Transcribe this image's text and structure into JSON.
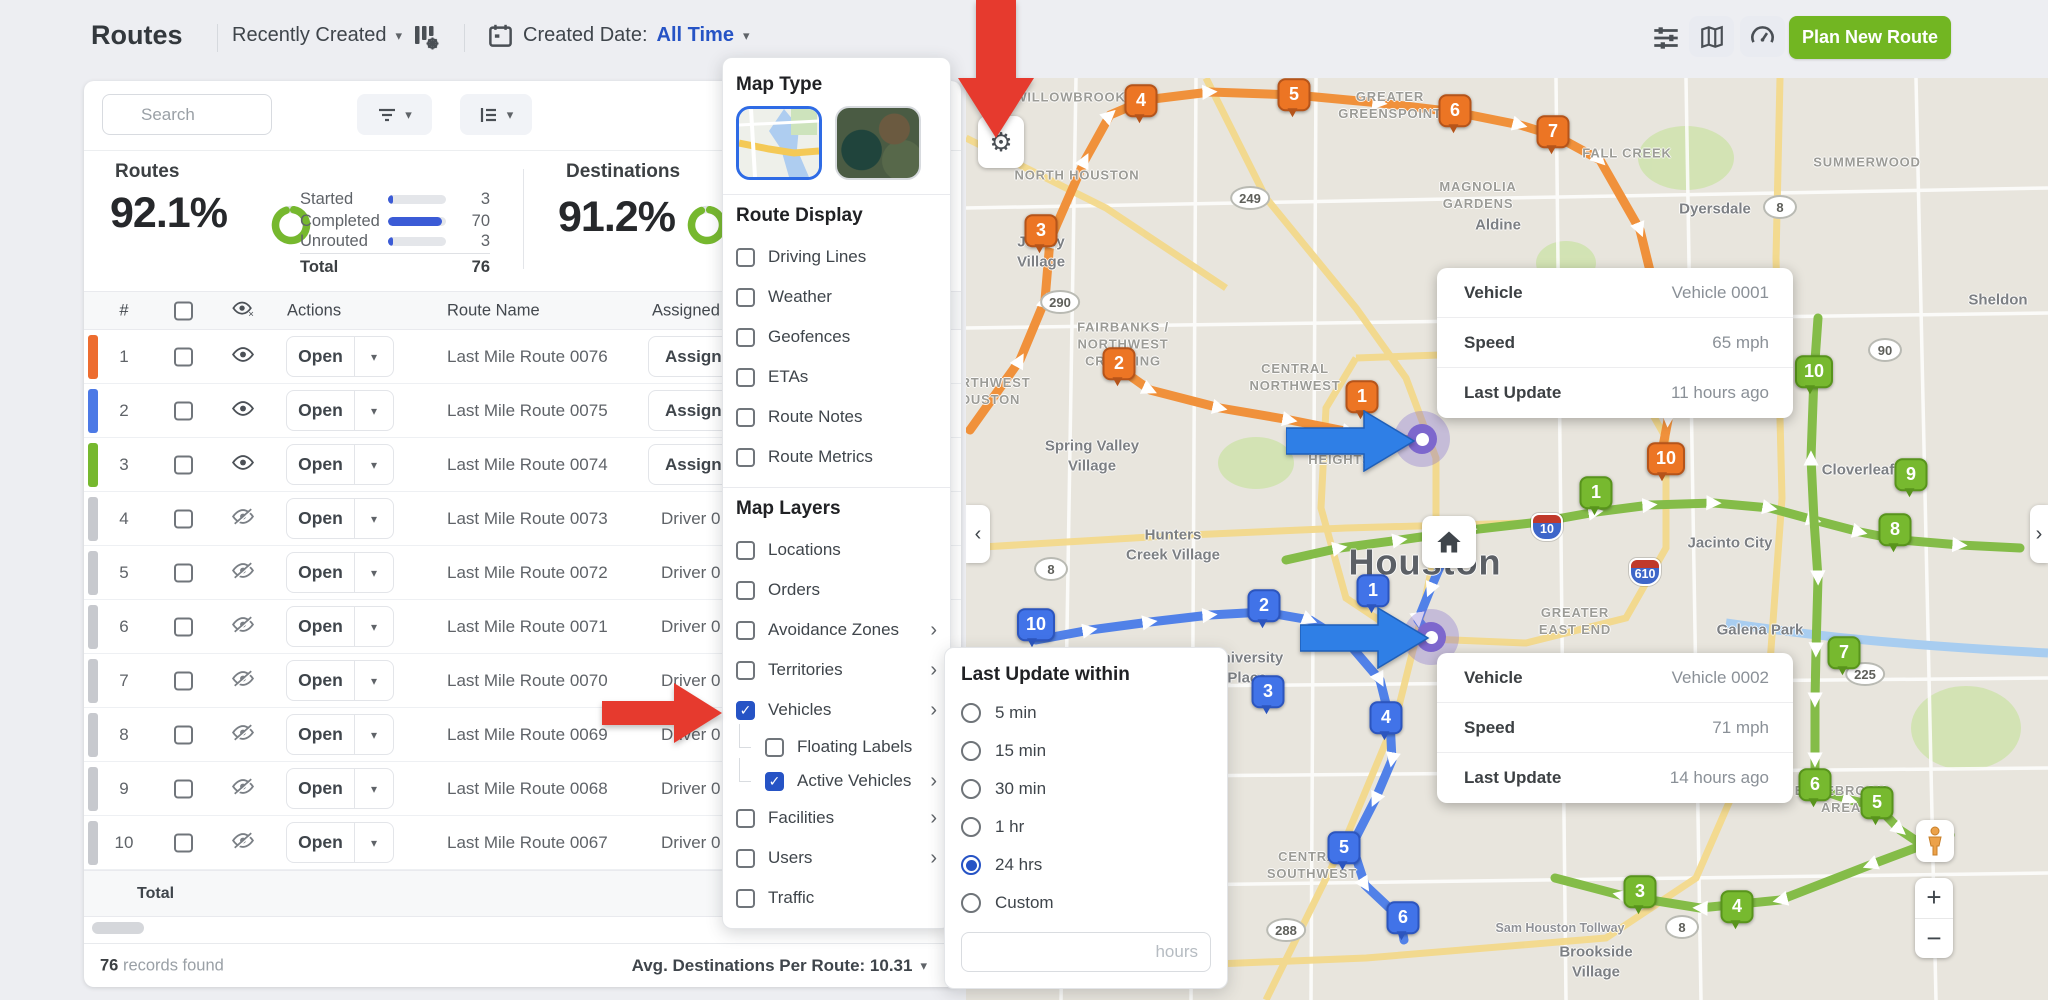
{
  "app": {
    "title": "Routes",
    "sort": "Recently Created",
    "created_date_label": "Created Date:",
    "created_date_value": "All Time",
    "plan_new_route": "Plan New Route",
    "search_placeholder": "Search"
  },
  "icons": {
    "caret_down": "▾",
    "check": "✓",
    "gear": "⚙",
    "collapse_left": "‹",
    "collapse_right": "›",
    "submenu_chevron": "›",
    "zoom_in": "+",
    "zoom_out": "−"
  },
  "stats": {
    "routes_label": "Routes",
    "routes_percent": "92.1%",
    "breakdown": [
      {
        "label": "Started",
        "value": "3",
        "pct": 8
      },
      {
        "label": "Completed",
        "value": "70",
        "pct": 93
      },
      {
        "label": "Unrouted",
        "value": "3",
        "pct": 8
      }
    ],
    "total_label": "Total",
    "total_value": "76",
    "destinations_label": "Destinations",
    "destinations_percent": "91.2%"
  },
  "table": {
    "headers": {
      "index": "#",
      "actions": "Actions",
      "route_name": "Route Name",
      "assigned": "Assigned"
    },
    "open_label": "Open",
    "total_label": "Total",
    "row_bar_colors": {
      "orange": "#ED6C2F",
      "blue": "#4C79E6",
      "green": "#76B82E",
      "gray": "#C7C9CE"
    },
    "rows": [
      {
        "n": "1",
        "bar": "orange",
        "eye": "on",
        "name": "Last Mile Route 0076",
        "assigned": "Assign U",
        "assigned_type": "button"
      },
      {
        "n": "2",
        "bar": "blue",
        "eye": "on",
        "name": "Last Mile Route 0075",
        "assigned": "Assign U",
        "assigned_type": "button"
      },
      {
        "n": "3",
        "bar": "green",
        "eye": "on",
        "name": "Last Mile Route 0074",
        "assigned": "Assign U",
        "assigned_type": "button"
      },
      {
        "n": "4",
        "bar": "gray",
        "eye": "off",
        "name": "Last Mile Route 0073",
        "assigned": "Driver 0",
        "assigned_type": "text"
      },
      {
        "n": "5",
        "bar": "gray",
        "eye": "off",
        "name": "Last Mile Route 0072",
        "assigned": "Driver 0",
        "assigned_type": "text"
      },
      {
        "n": "6",
        "bar": "gray",
        "eye": "off",
        "name": "Last Mile Route 0071",
        "assigned": "Driver 0",
        "assigned_type": "text"
      },
      {
        "n": "7",
        "bar": "gray",
        "eye": "off",
        "name": "Last Mile Route 0070",
        "assigned": "Driver 0",
        "assigned_type": "text"
      },
      {
        "n": "8",
        "bar": "gray",
        "eye": "off",
        "name": "Last Mile Route 0069",
        "assigned": "Driver 0",
        "assigned_type": "text"
      },
      {
        "n": "9",
        "bar": "gray",
        "eye": "off",
        "name": "Last Mile Route 0068",
        "assigned": "Driver 0",
        "assigned_type": "text"
      },
      {
        "n": "10",
        "bar": "gray",
        "eye": "off",
        "name": "Last Mile Route 0067",
        "assigned": "Driver 0",
        "assigned_type": "text"
      }
    ]
  },
  "footer": {
    "records_count": "76",
    "records_text": " records found",
    "avg_text": "Avg. Destinations Per Route: 10.31"
  },
  "map_settings": {
    "map_type_label": "Map Type",
    "route_display_label": "Route Display",
    "route_display": [
      {
        "label": "Driving Lines",
        "checked": false
      },
      {
        "label": "Weather",
        "checked": false
      },
      {
        "label": "Geofences",
        "checked": false
      },
      {
        "label": "ETAs",
        "checked": false
      },
      {
        "label": "Route Notes",
        "checked": false
      },
      {
        "label": "Route Metrics",
        "checked": false
      }
    ],
    "map_layers_label": "Map Layers",
    "map_layers": [
      {
        "label": "Locations",
        "checked": false
      },
      {
        "label": "Orders",
        "checked": false
      },
      {
        "label": "Avoidance Zones",
        "checked": false,
        "chevron": true
      },
      {
        "label": "Territories",
        "checked": false,
        "chevron": true
      },
      {
        "label": "Vehicles",
        "checked": true,
        "chevron": true
      },
      {
        "label": "Floating Labels",
        "checked": false,
        "indent": true
      },
      {
        "label": "Active Vehicles",
        "checked": true,
        "chevron": true,
        "indent": true
      },
      {
        "label": "Facilities",
        "checked": false,
        "chevron": true
      },
      {
        "label": "Users",
        "checked": false,
        "chevron": true
      },
      {
        "label": "Traffic",
        "checked": false
      }
    ]
  },
  "last_update": {
    "title": "Last Update within",
    "options": [
      "5 min",
      "15 min",
      "30 min",
      "1 hr",
      "24 hrs",
      "Custom"
    ],
    "selected": "24 hrs",
    "input_placeholder": "hours"
  },
  "vehicle_cards": [
    {
      "x": 1437,
      "y": 268,
      "rows": [
        [
          "Vehicle",
          "Vehicle 0001"
        ],
        [
          "Speed",
          "65 mph"
        ],
        [
          "Last Update",
          "11 hours ago"
        ]
      ]
    },
    {
      "x": 1437,
      "y": 653,
      "rows": [
        [
          "Vehicle",
          "Vehicle 0002"
        ],
        [
          "Speed",
          "71 mph"
        ],
        [
          "Last Update",
          "14 hours ago"
        ]
      ]
    }
  ],
  "map": {
    "markers": [
      {
        "c": "orange",
        "n": "4",
        "x": 1141,
        "y": 104
      },
      {
        "c": "orange",
        "n": "5",
        "x": 1294,
        "y": 98
      },
      {
        "c": "orange",
        "n": "6",
        "x": 1455,
        "y": 114
      },
      {
        "c": "orange",
        "n": "7",
        "x": 1553,
        "y": 135
      },
      {
        "c": "orange",
        "n": "3",
        "x": 1041,
        "y": 234
      },
      {
        "c": "orange",
        "n": "2",
        "x": 1119,
        "y": 367
      },
      {
        "c": "orange",
        "n": "1",
        "x": 1362,
        "y": 400
      },
      {
        "c": "orange",
        "n": "10",
        "x": 1666,
        "y": 462
      },
      {
        "c": "green",
        "n": "10",
        "x": 1814,
        "y": 375
      },
      {
        "c": "green",
        "n": "9",
        "x": 1911,
        "y": 478
      },
      {
        "c": "green",
        "n": "8",
        "x": 1895,
        "y": 533
      },
      {
        "c": "green",
        "n": "1",
        "x": 1596,
        "y": 496
      },
      {
        "c": "green",
        "n": "7",
        "x": 1844,
        "y": 656
      },
      {
        "c": "green",
        "n": "6",
        "x": 1815,
        "y": 788
      },
      {
        "c": "green",
        "n": "5",
        "x": 1877,
        "y": 806
      },
      {
        "c": "green",
        "n": "3",
        "x": 1640,
        "y": 895
      },
      {
        "c": "green",
        "n": "4",
        "x": 1737,
        "y": 910
      },
      {
        "c": "blue",
        "n": "10",
        "x": 1036,
        "y": 628
      },
      {
        "c": "blue",
        "n": "2",
        "x": 1264,
        "y": 609
      },
      {
        "c": "blue",
        "n": "1",
        "x": 1373,
        "y": 594
      },
      {
        "c": "blue",
        "n": "3",
        "x": 1268,
        "y": 695
      },
      {
        "c": "blue",
        "n": "4",
        "x": 1386,
        "y": 721
      },
      {
        "c": "blue",
        "n": "5",
        "x": 1344,
        "y": 851
      },
      {
        "c": "blue",
        "n": "6",
        "x": 1403,
        "y": 921
      }
    ],
    "labels": [
      {
        "text": "WILLOWBROOK",
        "x": 1070,
        "y": 98,
        "kind": "area"
      },
      {
        "text": "GREATER\nGREENSPOINT",
        "x": 1390,
        "y": 106,
        "kind": "area"
      },
      {
        "text": "NORTH HOUSTON",
        "x": 1077,
        "y": 176,
        "kind": "area"
      },
      {
        "text": "MAGNOLIA\nGARDENS",
        "x": 1478,
        "y": 196,
        "kind": "area"
      },
      {
        "text": "FALL CREEK",
        "x": 1627,
        "y": 154,
        "kind": "area"
      },
      {
        "text": "SUMMERWOOD",
        "x": 1867,
        "y": 163,
        "kind": "area"
      },
      {
        "text": "Dyersdale",
        "x": 1715,
        "y": 209,
        "kind": "city"
      },
      {
        "text": "Aldine",
        "x": 1498,
        "y": 225,
        "kind": "city"
      },
      {
        "text": "Jersey\nVillage",
        "x": 1041,
        "y": 252,
        "kind": "city"
      },
      {
        "text": "FAIRBANKS /\nNORTHWEST\nCROSSING",
        "x": 1123,
        "y": 345,
        "kind": "area"
      },
      {
        "text": "CENTRAL\nNORTHWEST",
        "x": 1295,
        "y": 378,
        "kind": "area"
      },
      {
        "text": "NORTHWEST\nHOUSTON",
        "x": 985,
        "y": 392,
        "kind": "area"
      },
      {
        "text": "GREATER\nHEIGHTS",
        "x": 1340,
        "y": 452,
        "kind": "area"
      },
      {
        "text": "Spring Valley\nVillage",
        "x": 1092,
        "y": 456,
        "kind": "city"
      },
      {
        "text": "Hunters\nCreek Village",
        "x": 1173,
        "y": 545,
        "kind": "city"
      },
      {
        "text": "Houston",
        "x": 1425,
        "y": 563,
        "kind": "big"
      },
      {
        "text": "Sheldon",
        "x": 1998,
        "y": 300,
        "kind": "city"
      },
      {
        "text": "Cloverleaf",
        "x": 1858,
        "y": 470,
        "kind": "city"
      },
      {
        "text": "Jacinto City",
        "x": 1730,
        "y": 543,
        "kind": "city"
      },
      {
        "text": "Galena Park",
        "x": 1760,
        "y": 630,
        "kind": "city"
      },
      {
        "text": "GREATER\nEAST END",
        "x": 1575,
        "y": 622,
        "kind": "area"
      },
      {
        "text": "University\nPlace",
        "x": 1247,
        "y": 668,
        "kind": "city"
      },
      {
        "text": "CENTRAL\nSOUTHWEST",
        "x": 1312,
        "y": 866,
        "kind": "area"
      },
      {
        "text": "EDGEBROOK\nAREA",
        "x": 1841,
        "y": 800,
        "kind": "area"
      },
      {
        "text": "Brookside\nVillage",
        "x": 1596,
        "y": 962,
        "kind": "city"
      },
      {
        "text": "Sam Houston Tollway",
        "x": 1560,
        "y": 928,
        "kind": "road"
      }
    ],
    "shields": [
      {
        "type": "oval",
        "text": "249",
        "x": 1250,
        "y": 198
      },
      {
        "type": "oval",
        "text": "290",
        "x": 1060,
        "y": 302
      },
      {
        "type": "oval",
        "text": "8",
        "x": 1780,
        "y": 207
      },
      {
        "type": "oval",
        "text": "8",
        "x": 1051,
        "y": 569
      },
      {
        "type": "oval",
        "text": "8",
        "x": 1682,
        "y": 927
      },
      {
        "type": "oval",
        "text": "90",
        "x": 1885,
        "y": 350
      },
      {
        "type": "oval",
        "text": "225",
        "x": 1865,
        "y": 674
      },
      {
        "type": "oval",
        "text": "288",
        "x": 1286,
        "y": 930
      },
      {
        "type": "interstate",
        "text": "610",
        "x": 1497,
        "y": 336
      },
      {
        "type": "interstate",
        "text": "610",
        "x": 1645,
        "y": 572
      },
      {
        "type": "interstate",
        "text": "10",
        "x": 1547,
        "y": 527
      }
    ]
  },
  "colors": {
    "accent_blue": "#2653C5",
    "accent_green": "#72B622",
    "ring_green": "#76B82E",
    "arrow_red": "#E63A2E",
    "arrow_blue": "#2F7FE6",
    "marker_orange": "#EC7524",
    "marker_green": "#77B92F",
    "marker_blue": "#4173E8"
  }
}
